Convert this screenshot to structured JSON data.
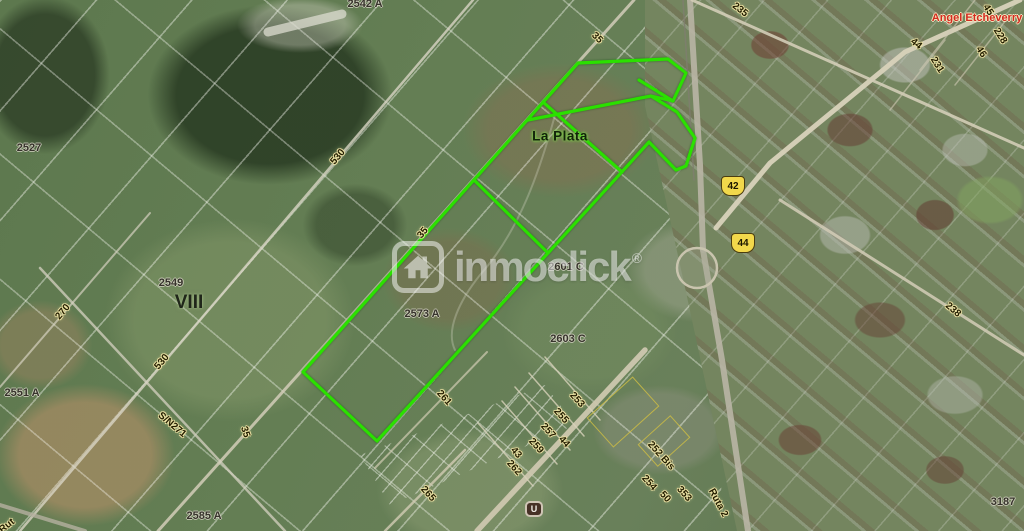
{
  "map": {
    "watermark": {
      "brand_text": "inmoclick",
      "registered_mark": "®",
      "icon": "house-icon"
    },
    "colors": {
      "highlight_green": "#2BE000",
      "shield_fill": "#F2D84B",
      "town_label_red": "#D42B1F"
    },
    "place_labels": [
      {
        "kind": "city",
        "text": "La Plata",
        "x": 560,
        "y": 136,
        "rot": 0
      },
      {
        "kind": "district",
        "text": "VIII",
        "x": 189,
        "y": 303,
        "rot": 0
      },
      {
        "kind": "town",
        "text": "Angel Etcheverry",
        "x": 977,
        "y": 18,
        "rot": 0
      }
    ],
    "parcel_labels": [
      {
        "text": "2542 A",
        "x": 365,
        "y": 4
      },
      {
        "text": "2527",
        "x": 29,
        "y": 148
      },
      {
        "text": "2549",
        "x": 171,
        "y": 283
      },
      {
        "text": "2551 A",
        "x": 22,
        "y": 393
      },
      {
        "text": "2573 A",
        "x": 422,
        "y": 314
      },
      {
        "text": "2601 C",
        "x": 566,
        "y": 267
      },
      {
        "text": "2603 C",
        "x": 568,
        "y": 339
      },
      {
        "text": "2585 A",
        "x": 204,
        "y": 516
      },
      {
        "text": "3187",
        "x": 1003,
        "y": 502
      }
    ],
    "road_labels": [
      {
        "text": "235",
        "x": 740,
        "y": 10,
        "rot": 38
      },
      {
        "text": "44",
        "x": 916,
        "y": 44,
        "rot": 38
      },
      {
        "text": "45",
        "x": 988,
        "y": 10,
        "rot": 58
      },
      {
        "text": "228",
        "x": 1000,
        "y": 36,
        "rot": 58
      },
      {
        "text": "46",
        "x": 981,
        "y": 52,
        "rot": 58
      },
      {
        "text": "231",
        "x": 937,
        "y": 65,
        "rot": 58
      },
      {
        "text": "35",
        "x": 597,
        "y": 38,
        "rot": 45
      },
      {
        "text": "530",
        "x": 338,
        "y": 157,
        "rot": -50
      },
      {
        "text": "270",
        "x": 63,
        "y": 312,
        "rot": -50
      },
      {
        "text": "530",
        "x": 162,
        "y": 362,
        "rot": -50
      },
      {
        "text": "35",
        "x": 423,
        "y": 233,
        "rot": -50
      },
      {
        "text": "S/N271",
        "x": 172,
        "y": 425,
        "rot": 40
      },
      {
        "text": "35",
        "x": 245,
        "y": 432,
        "rot": 72
      },
      {
        "text": "261",
        "x": 444,
        "y": 398,
        "rot": 48
      },
      {
        "text": "265",
        "x": 428,
        "y": 494,
        "rot": 48
      },
      {
        "text": "253",
        "x": 577,
        "y": 400,
        "rot": 48
      },
      {
        "text": "255",
        "x": 561,
        "y": 416,
        "rot": 48
      },
      {
        "text": "257",
        "x": 548,
        "y": 431,
        "rot": 48
      },
      {
        "text": "259",
        "x": 536,
        "y": 446,
        "rot": 48
      },
      {
        "text": "44",
        "x": 564,
        "y": 442,
        "rot": 48
      },
      {
        "text": "43",
        "x": 516,
        "y": 453,
        "rot": 48
      },
      {
        "text": "262",
        "x": 514,
        "y": 468,
        "rot": 48
      },
      {
        "text": "252 Bis",
        "x": 661,
        "y": 456,
        "rot": 48
      },
      {
        "text": "254",
        "x": 649,
        "y": 483,
        "rot": 48
      },
      {
        "text": "353",
        "x": 684,
        "y": 494,
        "rot": 48
      },
      {
        "text": "50",
        "x": 665,
        "y": 497,
        "rot": 48
      },
      {
        "text": "Ruta 2",
        "x": 718,
        "y": 503,
        "rot": 62
      },
      {
        "text": "238",
        "x": 953,
        "y": 310,
        "rot": 40
      },
      {
        "text": "Rut",
        "x": 7,
        "y": 526,
        "rot": -38
      }
    ],
    "route_shields": [
      {
        "text": "42",
        "x": 733,
        "y": 186
      },
      {
        "text": "44",
        "x": 743,
        "y": 243
      }
    ],
    "poi_marker": {
      "text": "U",
      "x": 534,
      "y": 509
    },
    "highlight": {
      "outer_points": "578,63 668,59 686,73 673,101 651,96 677,112 695,138 686,166 676,170 649,142 377,441 303,372",
      "inner_lines": [
        "639,80 673,101",
        "528,120 651,96",
        "543,102 622,172",
        "474,180 548,253"
      ]
    }
  }
}
